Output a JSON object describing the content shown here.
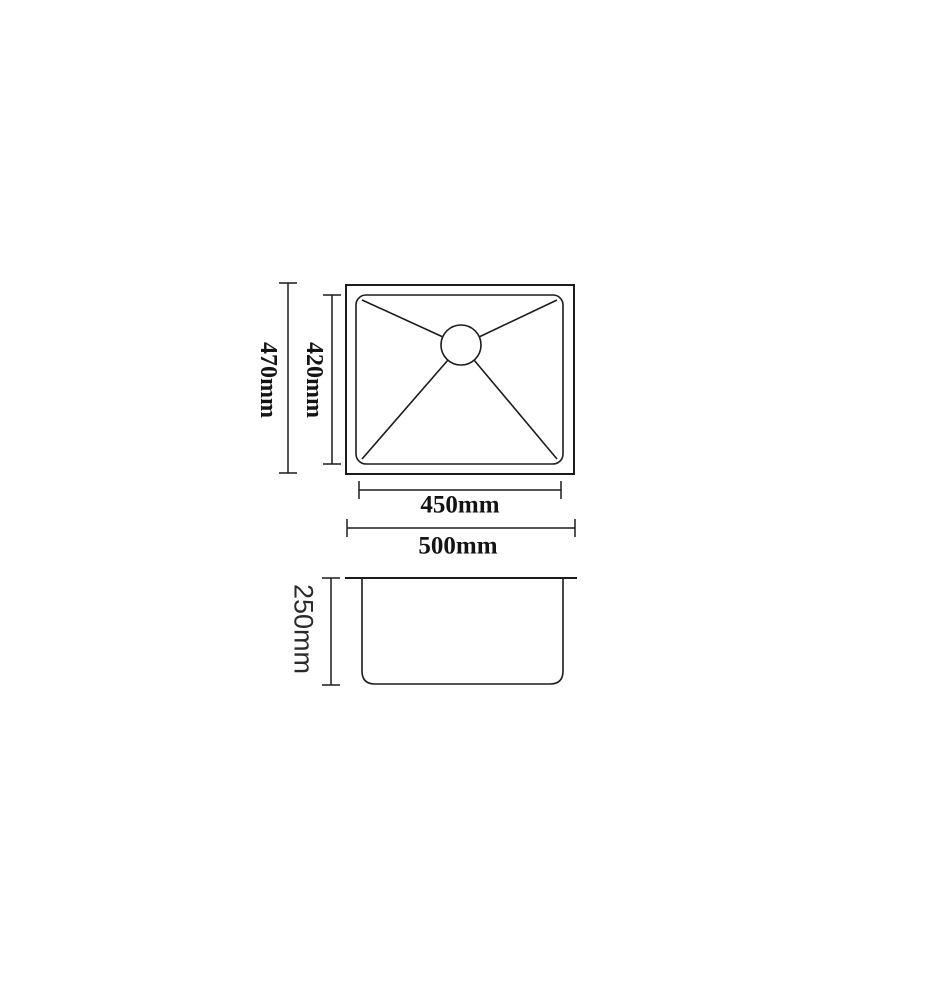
{
  "colors": {
    "line": "#1c1c1c",
    "text": "#141414",
    "background": "#ffffff"
  },
  "dimensions": {
    "outer_height": "470mm",
    "inner_height": "420mm",
    "inner_width": "450mm",
    "outer_width": "500mm",
    "bowl_depth": "250mm"
  }
}
